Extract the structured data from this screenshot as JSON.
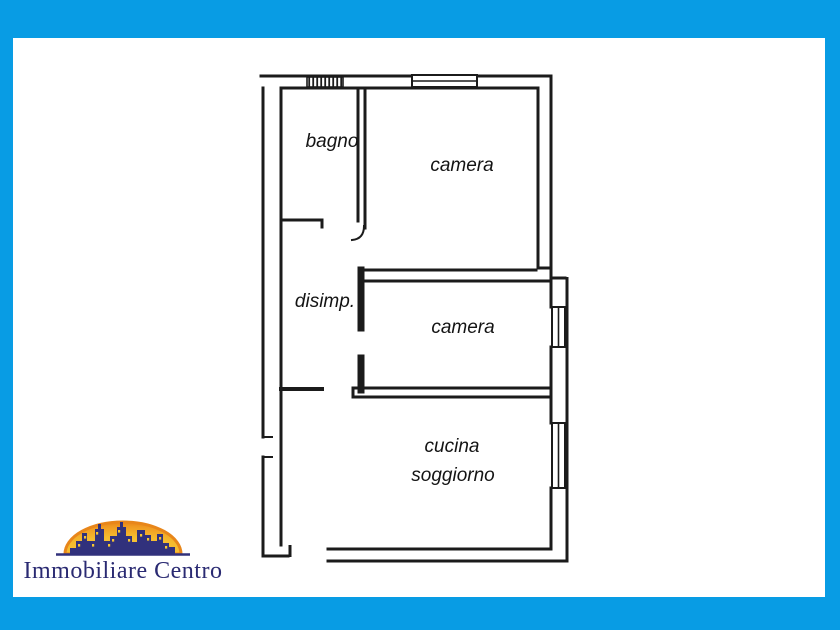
{
  "frame": {
    "border_color": "#089ce4",
    "canvas_color": "#ffffff"
  },
  "floorplan": {
    "ink_color": "#1b1b1b",
    "labels": {
      "bagno": "bagno",
      "camera_top": "camera",
      "disimp": "disimp.",
      "camera_mid": "camera",
      "cucina": "cucina",
      "soggiorno": "soggiorno"
    }
  },
  "logo": {
    "text": "Immobiliare Centro",
    "text_color": "#2a2a72",
    "skyline_color": "#31317c",
    "arch_core_color": "#f7c531",
    "arch_rim_color": "#e8861a"
  }
}
